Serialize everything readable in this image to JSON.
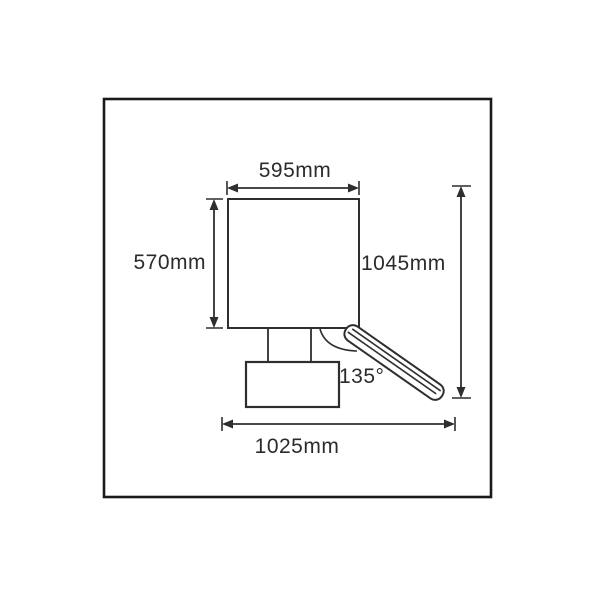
{
  "labels": {
    "top_width": "595mm",
    "left_height": "570mm",
    "right_height": "1045mm",
    "bottom_width": "1025mm",
    "angle": "135°"
  },
  "colors": {
    "frame": "#1a1a1a",
    "line": "#2e2e2e",
    "text": "#2b2b2b",
    "background": "#ffffff"
  }
}
